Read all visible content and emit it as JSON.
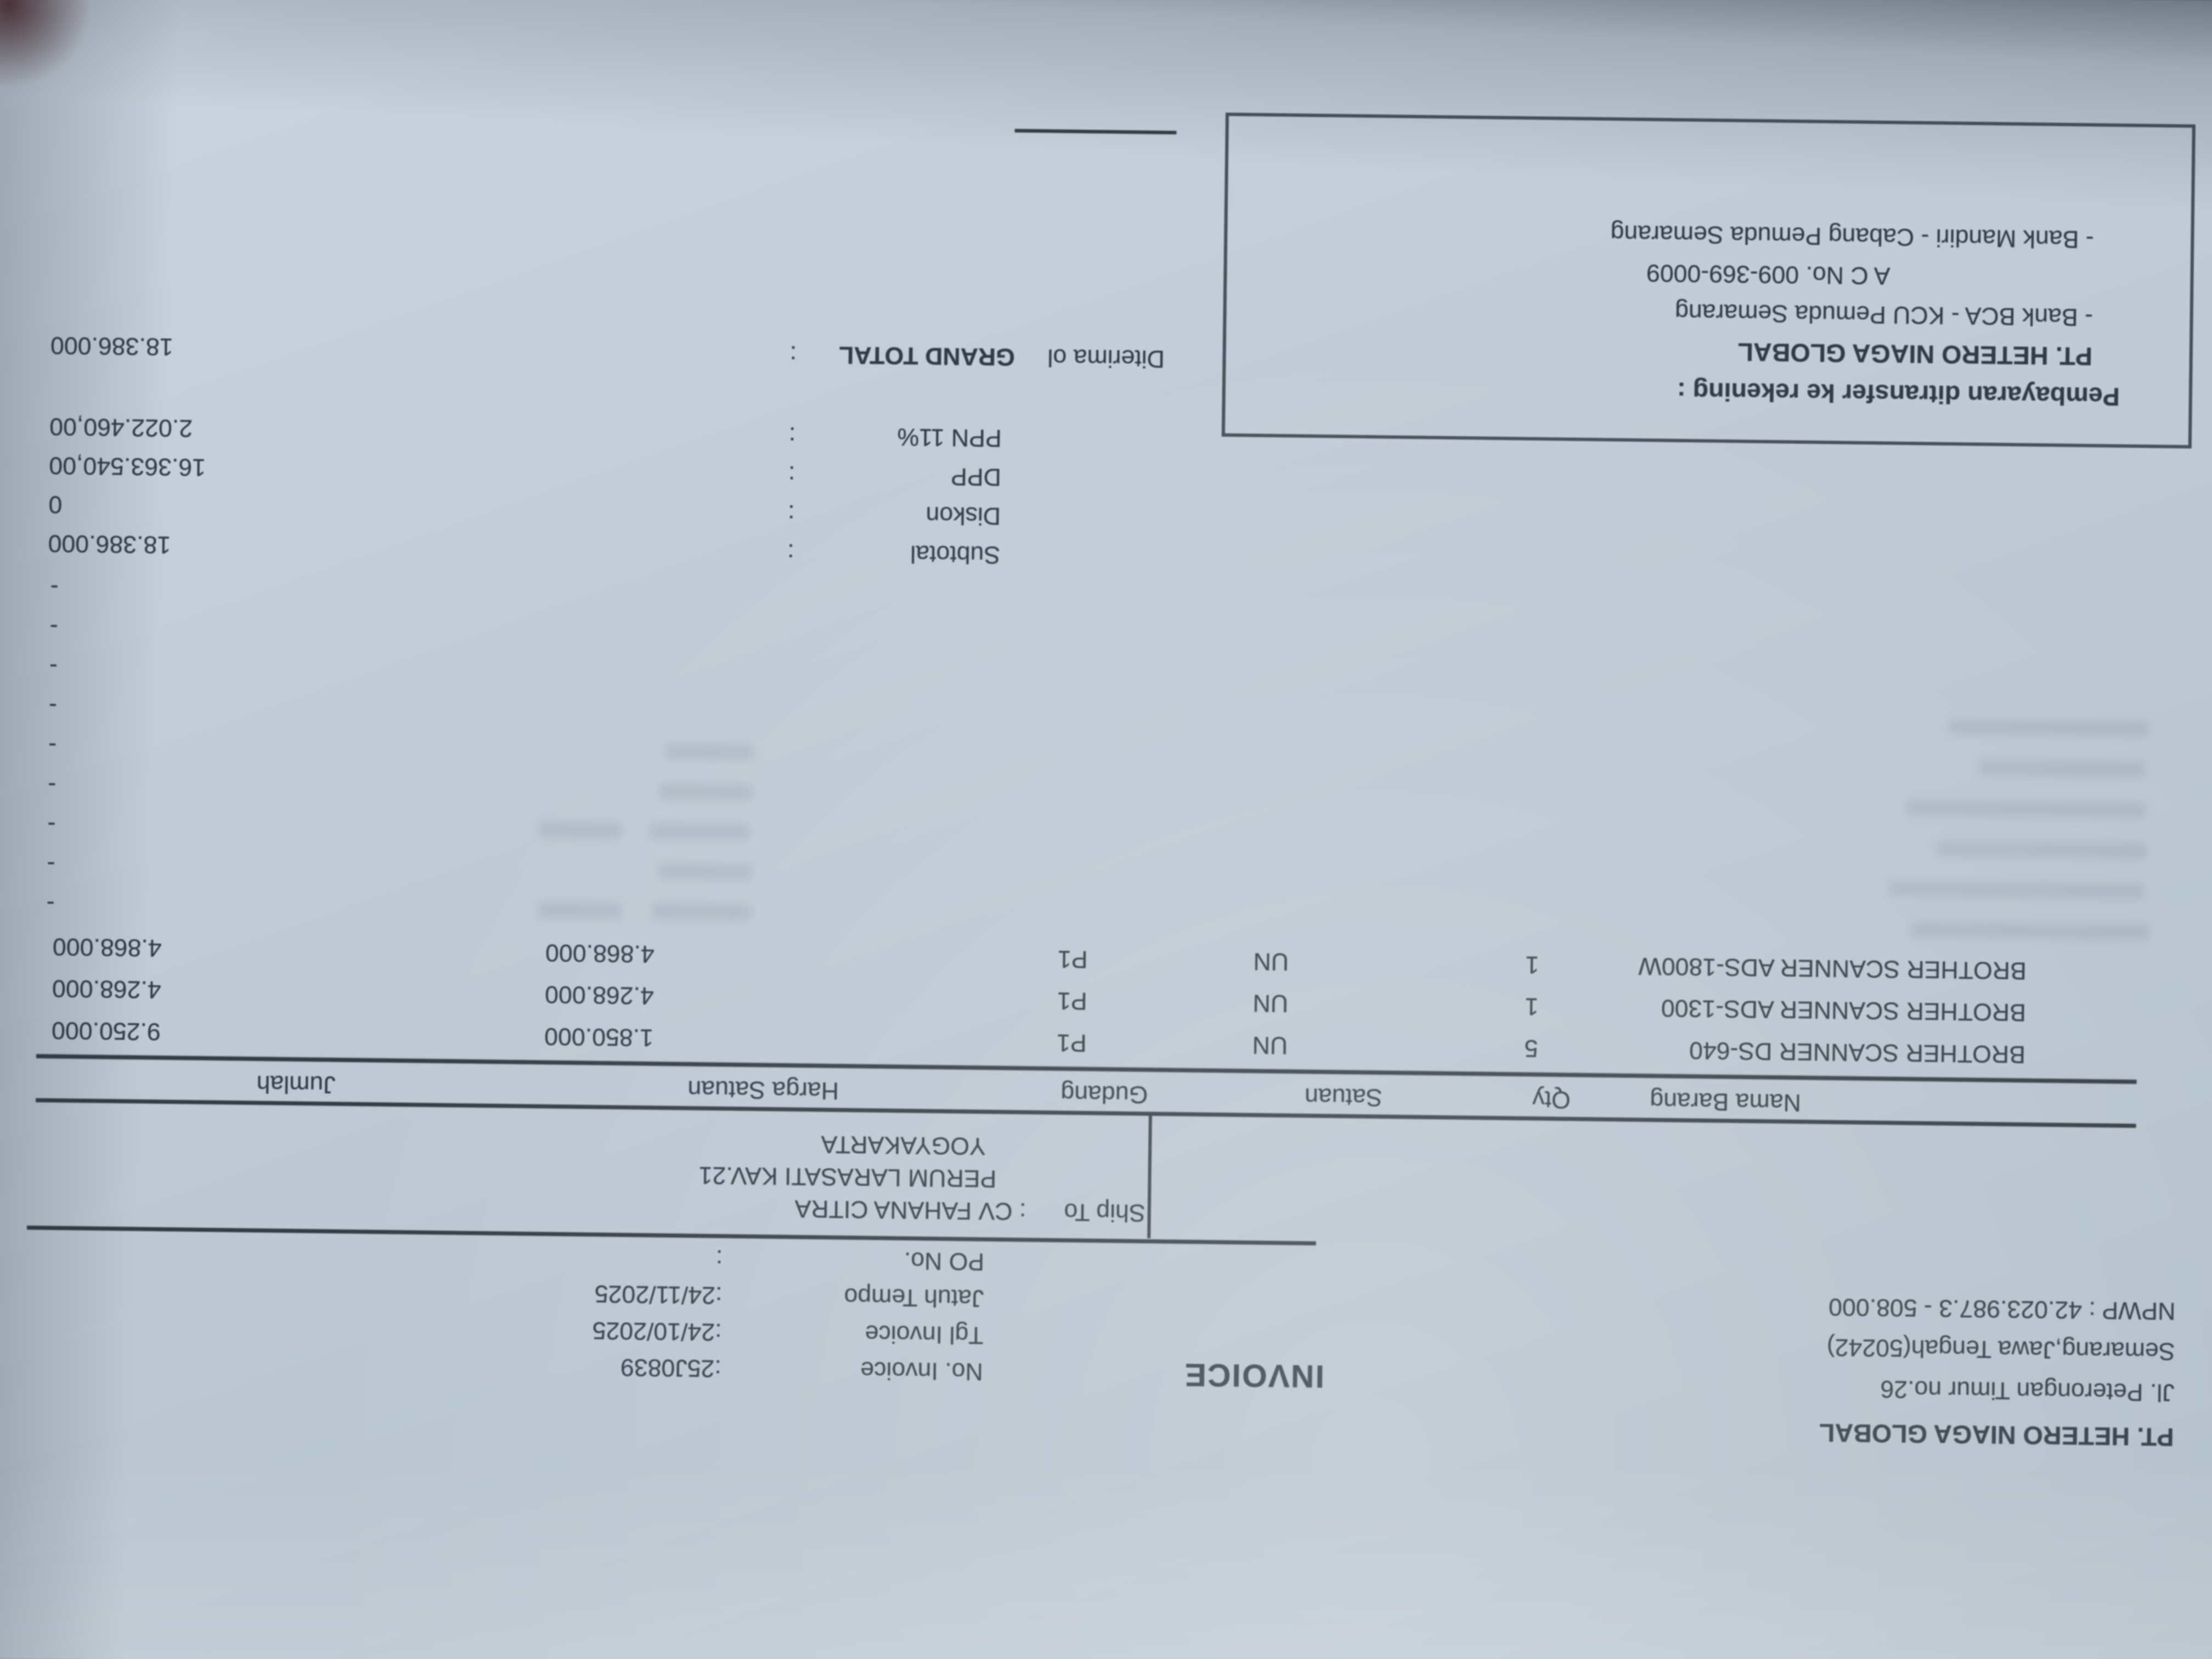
{
  "photo": {
    "rotation_deg": 180.7,
    "paper_color": "#bdc8d3",
    "ink_color": "#313b46"
  },
  "invoice": {
    "title": "INVOICE",
    "company": {
      "name": "PT. HETERO NIAGA GLOBAL",
      "address1": "Jl. Peterongan Timur no.26",
      "address2": "Semarang,Jawa Tengah(50242)",
      "npwp": "NPWP : 42.023.987.3 - 508.000"
    },
    "meta": [
      {
        "label": "No. Invoice",
        "value": ":25J0839"
      },
      {
        "label": "Tgl Invoice",
        "value": ":24/10/2025"
      },
      {
        "label": "Jatuh Tempo",
        "value": ":24/11/2025"
      },
      {
        "label": "PO No.",
        "value": ":"
      }
    ],
    "ship_to": {
      "label": "Ship To",
      "value": ": CV FAHANA CITRA",
      "line2": "PERUM LARASATI KAV.21",
      "line3": "YOGYAKARTA"
    },
    "table": {
      "headers": [
        "Nama Barang",
        "Qty",
        "Satuan",
        "Gudang",
        "Harga Satuan",
        "Jumlah"
      ],
      "rows": [
        {
          "name": "BROTHER SCANNER DS-640",
          "qty": "5",
          "satuan": "UN",
          "gudang": "P1",
          "harga": "1.850.000",
          "jumlah": "9.250.000"
        },
        {
          "name": "BROTHER SCANNER ADS-1300",
          "qty": "1",
          "satuan": "UN",
          "gudang": "P1",
          "harga": "4.268.000",
          "jumlah": "4.268.000"
        },
        {
          "name": "BROTHER SCANNER ADS-1800W",
          "qty": "1",
          "satuan": "UN",
          "gudang": "P1",
          "harga": "4.868.000",
          "jumlah": "4.868.000"
        }
      ],
      "empty_row_marker": "-",
      "empty_row_count": 9
    },
    "totals": [
      {
        "label": "Subtotal",
        "sep": ":",
        "value": "18.386.000"
      },
      {
        "label": "Diskon",
        "sep": ":",
        "value": "0"
      },
      {
        "label": "DPP",
        "sep": ":",
        "value": "16.363.540,00"
      },
      {
        "label": "PPN 11%",
        "sep": ":",
        "value": "2.022.460,00"
      }
    ],
    "grand_total": {
      "received_label": "Diterima ol",
      "label": "GRAND TOTAL",
      "sep": ":",
      "value": "18.386.000"
    },
    "payment": {
      "title": "Pembayaran ditransfer ke rekening :",
      "account_name": "PT. HETERO NIAGA GLOBAL",
      "lines": [
        "- Bank BCA - KCU Pemuda Semarang",
        "A C No. 009-369-0009",
        "- Bank Mandiri - Cabang Pemuda Semarang"
      ]
    }
  }
}
